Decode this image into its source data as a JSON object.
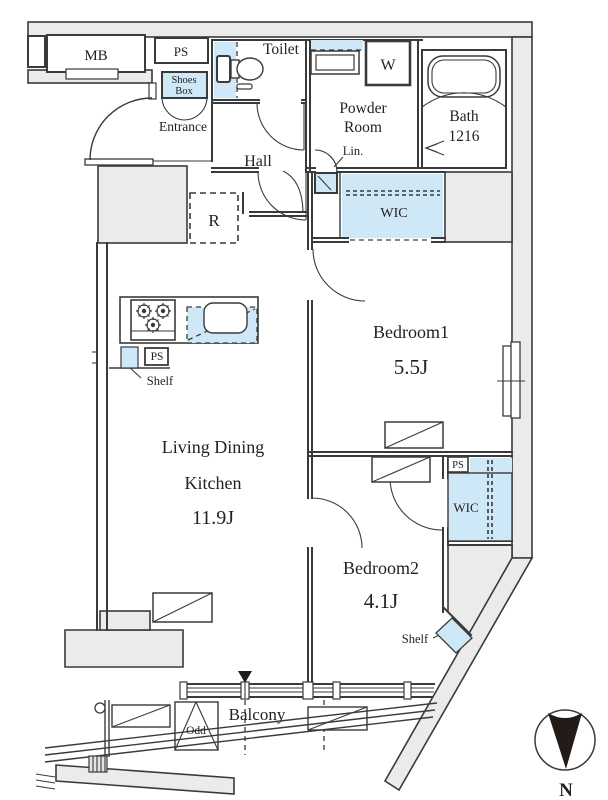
{
  "labels": {
    "mb": "MB",
    "ps": "PS",
    "shoes1": "Shoes",
    "shoes2": "Box",
    "entrance": "Entrance",
    "toilet": "Toilet",
    "powder1": "Powder",
    "powder2": "Room",
    "washer": "W",
    "bath1": "Bath",
    "bath2": "1216",
    "hall": "Hall",
    "lin": "Lin.",
    "wic": "WIC",
    "fridge": "R",
    "shelf": "Shelf",
    "bedroom1": "Bedroom1",
    "bedroom1_size": "5.5J",
    "ldk1": "Living Dining",
    "ldk2": "Kitchen",
    "ldk_size": "11.9J",
    "bedroom2": "Bedroom2",
    "bedroom2_size": "4.1J",
    "balcony": "Balcony",
    "odd": "Odd",
    "north": "N"
  },
  "colors": {
    "fixture_blue": "#cfe8f7",
    "wall_gray": "#ebebeb",
    "line": "#3a3a3a"
  }
}
